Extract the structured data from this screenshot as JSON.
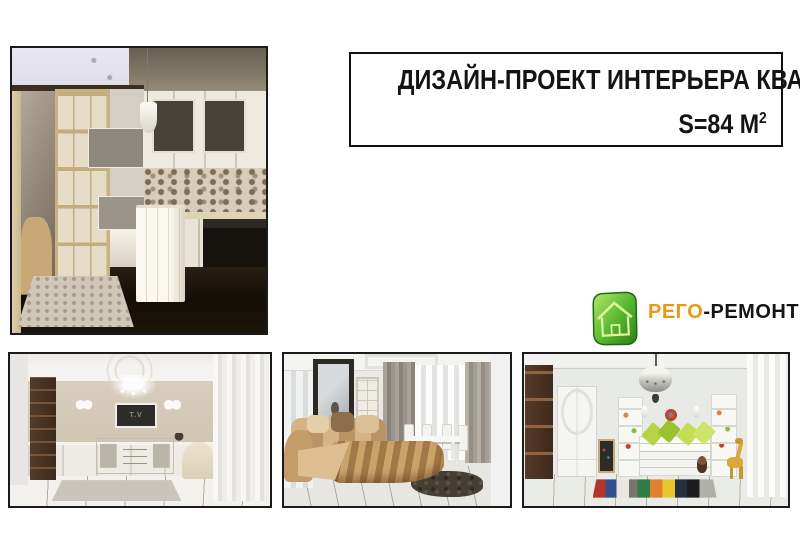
{
  "slide": {
    "background_color": "#ffffff"
  },
  "title_box": {
    "line1": "ДИЗАЙН-ПРОЕКТ ИНТЕРЬЕРА КВАРТИРЫ",
    "line2_base": "S=84 М",
    "line2_sup": "2"
  },
  "logo": {
    "brand_accent": "РЕГО",
    "brand_rest": "-РЕМОНТ",
    "accent_color": "#EB9812",
    "text_color": "#151515",
    "icon": "house-icon",
    "icon_green_light": "#B7E96E",
    "icon_green_dark": "#2C7F16"
  },
  "photos": {
    "living_room_tv": {
      "screen_label": "T.V"
    }
  }
}
